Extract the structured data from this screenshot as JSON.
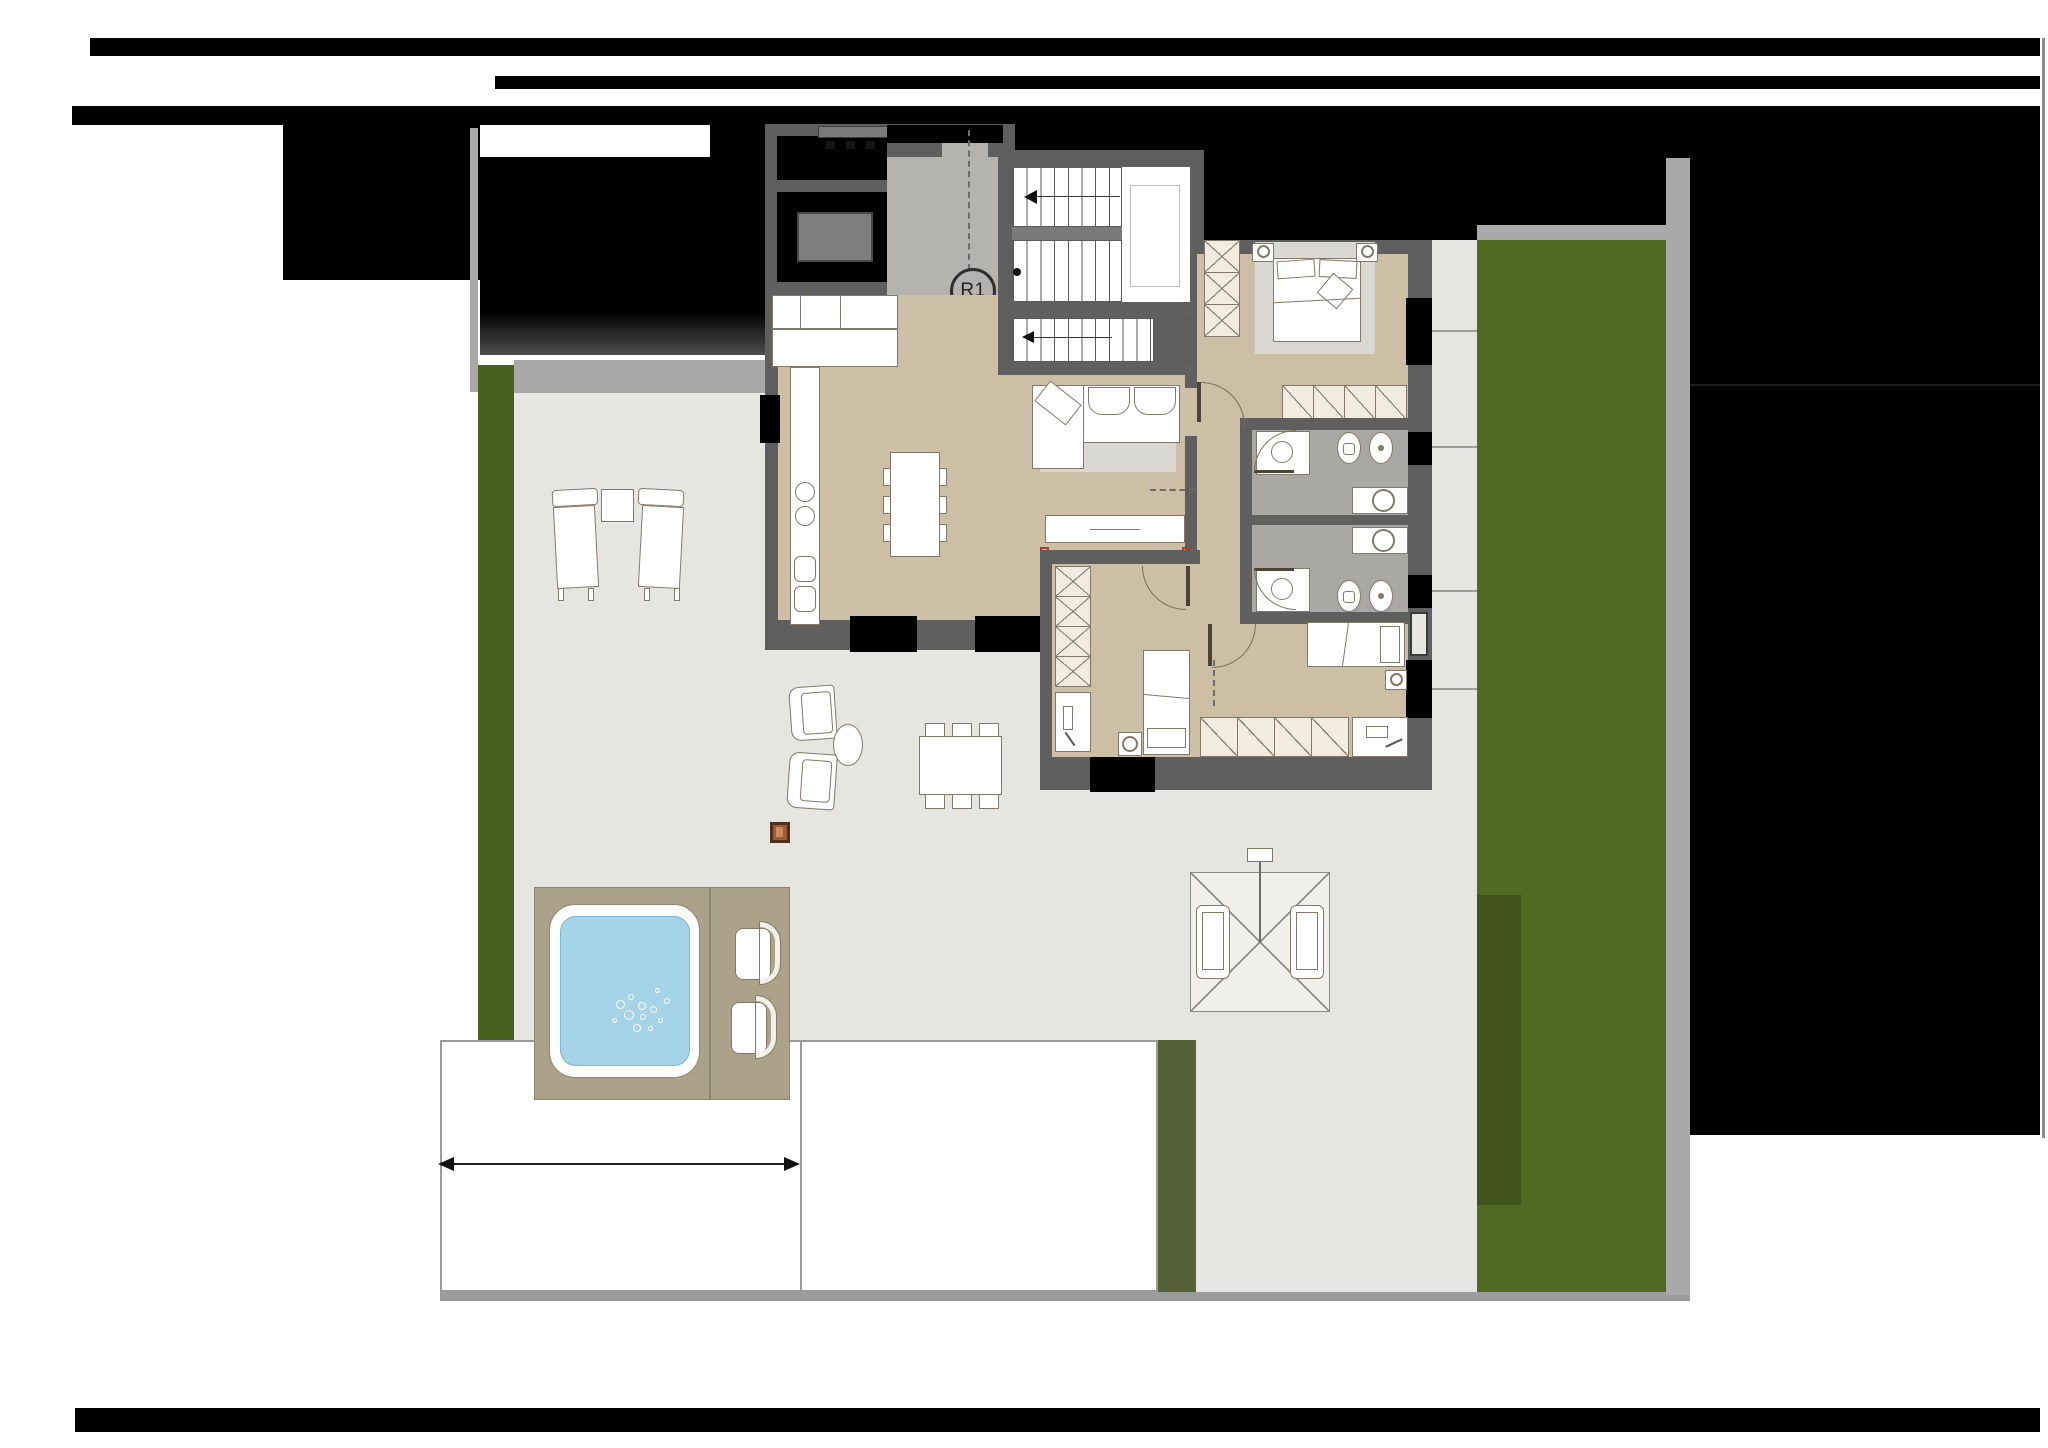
{
  "plan": {
    "riser_label": "R1",
    "type": "architectural-floor-plan",
    "regions": [
      "stair-hall",
      "staircase",
      "kitchen-living-room",
      "master-bedroom",
      "bathroom-1",
      "bathroom-2",
      "bedroom-2",
      "bedroom-3",
      "terrace",
      "hot-tub-deck",
      "lawn",
      "driveway",
      "hedge"
    ],
    "furniture": [
      "kitchen-island",
      "sofa",
      "double-bed",
      "single-bed",
      "wardrobes",
      "toilet",
      "bidet",
      "shower",
      "washbasin",
      "outdoor-armchairs",
      "outdoor-dining-set",
      "sun-parasol-seat",
      "hot-tub",
      "fire-pit-box"
    ]
  },
  "colors": {
    "black": "#000000",
    "wall": "#5f5f5f",
    "wall-light": "#a9a9a9",
    "terrace": "#e5e5e2",
    "floor-tan": "#cdbfa6",
    "floor-landing": "#b5b3b0",
    "floor-bath": "#a9a8a5",
    "lawn": "#4f6b22",
    "lawn-strip": "#47611c",
    "hedge": "#3e5418",
    "hedge-gray": "#566036",
    "furn": "#f1ebe0",
    "furn-line": "#83796a",
    "deck": "#aca289",
    "water": "#a5d3e8",
    "rug": "#dad8d3",
    "red-mark": "#b03a2e",
    "brown-box": "#9c5c3a"
  }
}
